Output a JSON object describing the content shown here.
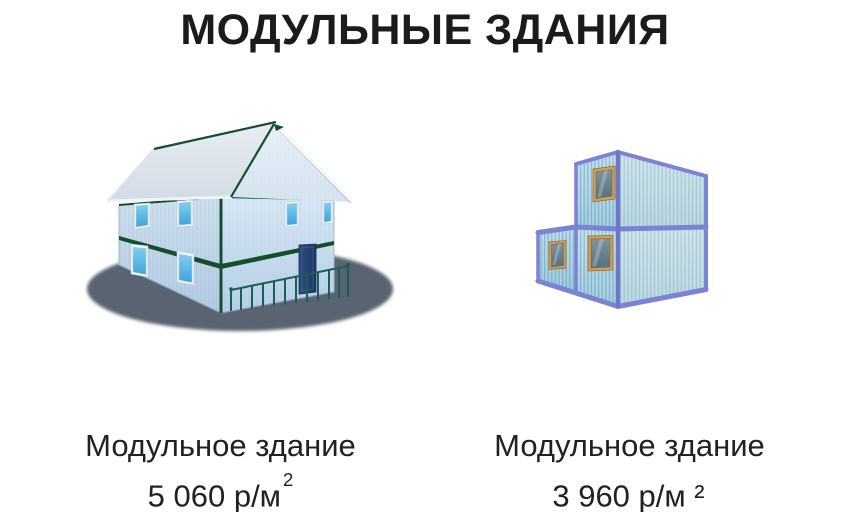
{
  "page": {
    "title": "МОДУЛЬНЫЕ ЗДАНИЯ",
    "background": "#ffffff"
  },
  "products": [
    {
      "name": "Модульное здание",
      "price": "5 060 р/м",
      "price_sup": "2",
      "image": "two-story-modular-house"
    },
    {
      "name": "Модульное здание",
      "price": "3 960 р/м ²",
      "price_sup": "",
      "image": "stacked-container-modules"
    }
  ],
  "colors": {
    "title_text": "#1b1b1b",
    "caption_text": "#212121",
    "house_wall_blue": "#c6dcee",
    "house_roof_gray": "#dde4eb",
    "house_trim_green": "#134f2d",
    "house_door_navy": "#24426f",
    "house_window_glass": "#55b9e9",
    "ground_shadow": "#5a6471",
    "container_frame_periwinkle": "#7b83d4",
    "container_wall_teal": "#b7dbe8",
    "container_window_wood": "#d2a159",
    "container_window_glass": "#5d7280"
  }
}
